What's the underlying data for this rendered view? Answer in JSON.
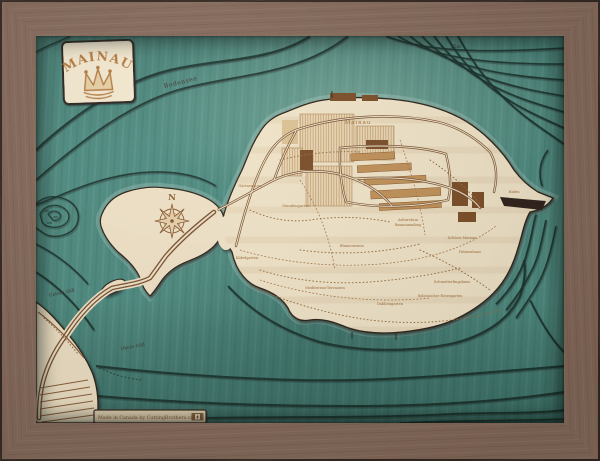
{
  "cartouche": {
    "title": "MAINAU"
  },
  "water": {
    "lake_label": "Bodensee",
    "bay_upper_label": "Untere Güll",
    "bay_lower_label": "Obere Güll",
    "depth_label": "25m"
  },
  "compass": {
    "north_label": "N"
  },
  "island": {
    "name_label": "Mainau",
    "feature_labels": [
      {
        "text": "Gärtnerturm"
      },
      {
        "text": "Staudengarten"
      },
      {
        "text": "Blumenwiese"
      },
      {
        "text": "Arboretum"
      },
      {
        "text": "Baumsammlung"
      },
      {
        "text": "Schloss Mainau"
      },
      {
        "text": "Palmenhaus"
      },
      {
        "text": "Schmetterlingshaus"
      },
      {
        "text": "Italienischer Rosengarten"
      },
      {
        "text": "Dahliengarten"
      },
      {
        "text": "Mediterran-Terrassen"
      },
      {
        "text": "Kübelgarten"
      },
      {
        "text": "Hafen"
      }
    ]
  },
  "plaque": {
    "text": "Made in Canada by CuttingBrothers.ca"
  },
  "colors": {
    "water": "#4e8b80",
    "wood_light": "#f2e5c9",
    "frame": "#84695a",
    "contour": "#17302a",
    "engrave": "#a06c38"
  }
}
